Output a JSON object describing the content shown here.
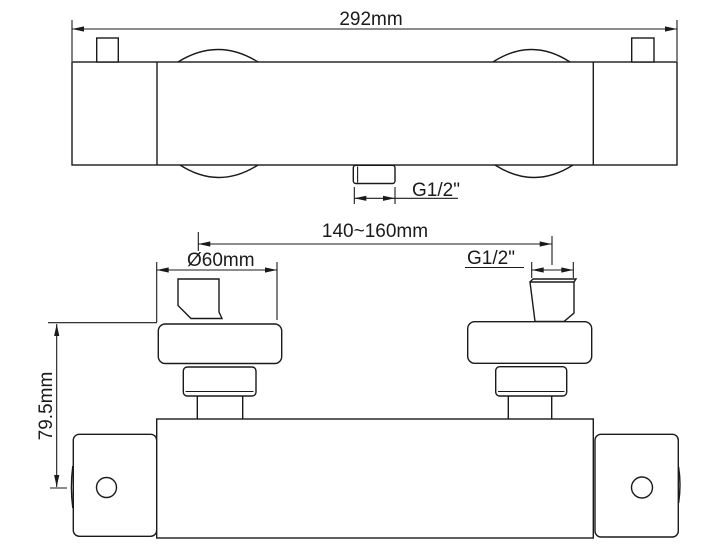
{
  "colors": {
    "background": "#ffffff",
    "line": "#1a1a1a",
    "text": "#1a1a1a"
  },
  "labels": {
    "overall_width": "292mm",
    "outlet_thread": "G1/2\"",
    "inlet_spacing": "140~160mm",
    "escutcheon_diameter": "Ø60mm",
    "inlet_thread": "G1/2\"",
    "mount_height": "79.5mm"
  }
}
